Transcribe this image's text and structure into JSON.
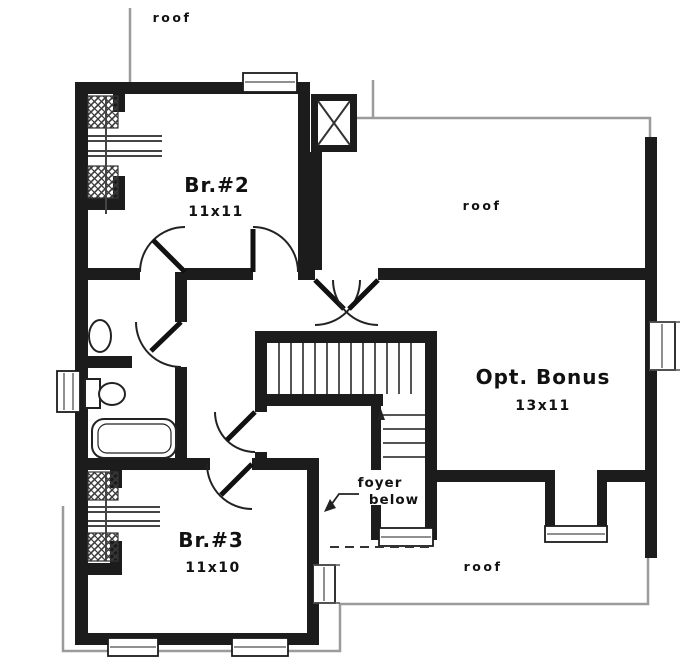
{
  "rooms": [
    {
      "name": "Br.#2",
      "dims": "11x11"
    },
    {
      "name": "Opt. Bonus",
      "dims": "13x11"
    },
    {
      "name": "Br.#3",
      "dims": "11x10"
    }
  ],
  "roof_labels": {
    "top": "roof",
    "right": "roof",
    "bottom": "roof"
  },
  "annotations": {
    "foyer_line1": "foyer",
    "foyer_line2": "below"
  },
  "colors": {
    "wall": "#1c1c1c",
    "roof_line": "#9b9b9b",
    "ink": "#111111",
    "paper": "#ffffff"
  }
}
